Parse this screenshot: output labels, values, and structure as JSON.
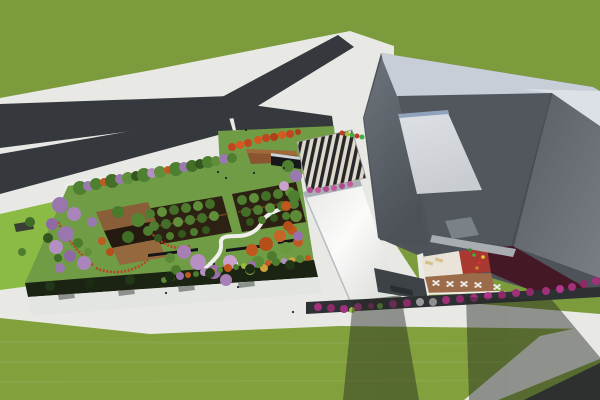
{
  "scene_type": "architectural-aerial-3d-render",
  "palette": {
    "grass_top": "#7c9b3c",
    "grass_bottom": "#82a03c",
    "pavement": "#e8e9e5",
    "asphalt": "#35383c",
    "lime_lawn": "#8cbb45",
    "garden_lawn": "#6f9c45",
    "walkway": "#ecedea",
    "hedge": "#1b2413",
    "facade": "#e3e5e2",
    "orchard_floor": "#2c2113",
    "stairs_dark": "#26262a",
    "stairs_light": "#ded9cb",
    "band_light": "#c8ced8",
    "band_lighter": "#dce1e7",
    "bldg_base": "#4d5358",
    "plane_mid": "#51575d",
    "skylight_edge": "#8fa3bd",
    "small_panel": "#7a8187",
    "fascia": "#a8adb2",
    "courtyard_cream": "#eae3d8",
    "courtyard_red": "#a83830",
    "courtyard_maroon": "#451826",
    "deck_brown": "#9c6b49",
    "deck_wedge": "#8a5530",
    "shelter_dark": "#17181a",
    "strip_dark": "#2e3134",
    "flatroof": "#3d4246",
    "shadow": "#23281f",
    "path_white": "#efefec",
    "red_flowers": "#c23b22",
    "table_white": "#f2f2f0",
    "lounger_beige": "#d9c08e",
    "person_dark": "#26262a"
  },
  "scene": {
    "trees": [
      [
        80,
        188,
        7,
        "#4f7f30"
      ],
      [
        88,
        186,
        5,
        "#9a78b0"
      ],
      [
        96,
        184,
        6,
        "#4f7f30"
      ],
      [
        104,
        182,
        4,
        "#c05a22"
      ],
      [
        112,
        181,
        7,
        "#446f28"
      ],
      [
        120,
        179,
        5,
        "#9a78b0"
      ],
      [
        128,
        178,
        6,
        "#5f8f38"
      ],
      [
        136,
        176,
        5,
        "#33571e"
      ],
      [
        144,
        175,
        7,
        "#4f7f30"
      ],
      [
        152,
        173,
        5,
        "#b48fc2"
      ],
      [
        160,
        172,
        6,
        "#5f8f38"
      ],
      [
        168,
        170,
        4,
        "#c05a22"
      ],
      [
        176,
        169,
        7,
        "#4f7f30"
      ],
      [
        184,
        167,
        5,
        "#9a78b0"
      ],
      [
        192,
        166,
        6,
        "#446f28"
      ],
      [
        200,
        164,
        5,
        "#33571e"
      ],
      [
        208,
        162,
        6,
        "#4f7f30"
      ],
      [
        216,
        161,
        5,
        "#5f8f38"
      ],
      [
        224,
        159,
        5,
        "#9a78b0"
      ],
      [
        232,
        158,
        5,
        "#4f7f30"
      ],
      [
        60,
        205,
        8,
        "#9a76ae"
      ],
      [
        74,
        214,
        7,
        "#aa85bc"
      ],
      [
        52,
        224,
        6,
        "#8f6ba6"
      ],
      [
        66,
        234,
        8,
        "#9a76ae"
      ],
      [
        56,
        247,
        7,
        "#b48fc2"
      ],
      [
        70,
        256,
        6,
        "#8f6ba6"
      ],
      [
        84,
        263,
        7,
        "#aa85bc"
      ],
      [
        60,
        268,
        5,
        "#9a76ae"
      ],
      [
        78,
        243,
        5,
        "#4c7b2e"
      ],
      [
        88,
        252,
        4,
        "#5f8f38"
      ],
      [
        92,
        222,
        5,
        "#9a78b0"
      ],
      [
        118,
        212,
        6,
        "#4a7a2c"
      ],
      [
        138,
        220,
        7,
        "#558433"
      ],
      [
        128,
        237,
        6,
        "#3f6d26"
      ],
      [
        148,
        231,
        5,
        "#4e7d2f"
      ],
      [
        102,
        241,
        4,
        "#c05a20"
      ],
      [
        110,
        252,
        4,
        "#b54f1a"
      ],
      [
        150,
        214,
        5,
        "#4e7d2f"
      ],
      [
        162,
        212,
        5,
        "#5f8f38"
      ],
      [
        174,
        210,
        5,
        "#446f28"
      ],
      [
        186,
        208,
        5,
        "#4e7d2f"
      ],
      [
        198,
        206,
        5,
        "#5f8f38"
      ],
      [
        210,
        204,
        5,
        "#446f28"
      ],
      [
        154,
        226,
        5,
        "#4e7d2f"
      ],
      [
        166,
        224,
        5,
        "#446f28"
      ],
      [
        178,
        222,
        5,
        "#5f8f38"
      ],
      [
        190,
        220,
        5,
        "#4e7d2f"
      ],
      [
        202,
        218,
        5,
        "#446f28"
      ],
      [
        214,
        216,
        5,
        "#5f8f38"
      ],
      [
        158,
        238,
        4,
        "#33571e"
      ],
      [
        170,
        236,
        4,
        "#4e7d2f"
      ],
      [
        182,
        234,
        4,
        "#33571e"
      ],
      [
        194,
        232,
        4,
        "#4e7d2f"
      ],
      [
        206,
        230,
        4,
        "#33571e"
      ],
      [
        242,
        200,
        5,
        "#4e7d2f"
      ],
      [
        254,
        198,
        5,
        "#5f8f38"
      ],
      [
        266,
        196,
        5,
        "#446f28"
      ],
      [
        278,
        194,
        5,
        "#4e7d2f"
      ],
      [
        290,
        192,
        5,
        "#5f8f38"
      ],
      [
        246,
        212,
        5,
        "#446f28"
      ],
      [
        258,
        210,
        5,
        "#4e7d2f"
      ],
      [
        270,
        208,
        5,
        "#5f8f38"
      ],
      [
        282,
        206,
        5,
        "#446f28"
      ],
      [
        294,
        204,
        5,
        "#4e7d2f"
      ],
      [
        250,
        222,
        4,
        "#33571e"
      ],
      [
        262,
        220,
        4,
        "#4e7d2f"
      ],
      [
        274,
        218,
        4,
        "#33571e"
      ],
      [
        286,
        216,
        4,
        "#4e7d2f"
      ],
      [
        184,
        252,
        7,
        "#a87fb5"
      ],
      [
        198,
        262,
        8,
        "#b88fc5"
      ],
      [
        214,
        272,
        7,
        "#9a6fae"
      ],
      [
        226,
        280,
        6,
        "#a87fb5"
      ],
      [
        170,
        258,
        5,
        "#5c8a36"
      ],
      [
        176,
        270,
        5,
        "#4e7c2d"
      ],
      [
        230,
        262,
        7,
        "#c9a0ce"
      ],
      [
        252,
        250,
        6,
        "#c2571d"
      ],
      [
        266,
        244,
        7,
        "#b54f1a"
      ],
      [
        280,
        236,
        6,
        "#c86426"
      ],
      [
        292,
        230,
        5,
        "#c2571d"
      ],
      [
        258,
        262,
        6,
        "#5d8c38"
      ],
      [
        272,
        256,
        5,
        "#4e7c2d"
      ],
      [
        286,
        248,
        6,
        "#6a9a40"
      ],
      [
        298,
        242,
        5,
        "#c05a22"
      ],
      [
        250,
        270,
        5,
        "#8fae4a"
      ],
      [
        264,
        268,
        4,
        "#d0a23a"
      ],
      [
        164,
        280,
        3,
        "#5c8a36"
      ],
      [
        172,
        278,
        3,
        "#a0b83c"
      ],
      [
        180,
        276,
        4,
        "#9a6fae"
      ],
      [
        188,
        275,
        3,
        "#c05a22"
      ],
      [
        196,
        274,
        3,
        "#4e7c2d"
      ],
      [
        204,
        272,
        4,
        "#b48fc2"
      ],
      [
        212,
        271,
        3,
        "#d0a23a"
      ],
      [
        220,
        270,
        3,
        "#5c8a36"
      ],
      [
        228,
        268,
        4,
        "#c2571d"
      ],
      [
        236,
        267,
        3,
        "#4e7c2d"
      ],
      [
        244,
        266,
        3,
        "#a0b83c"
      ],
      [
        252,
        265,
        4,
        "#9a6fae"
      ],
      [
        260,
        264,
        3,
        "#5c8a36"
      ],
      [
        268,
        263,
        3,
        "#c05a22"
      ],
      [
        276,
        262,
        4,
        "#4e7c2d"
      ],
      [
        284,
        261,
        3,
        "#b48fc2"
      ],
      [
        292,
        260,
        3,
        "#d0a23a"
      ],
      [
        300,
        259,
        4,
        "#5c8a36"
      ],
      [
        308,
        258,
        3,
        "#c2571d"
      ],
      [
        288,
        166,
        6,
        "#4f7f30"
      ],
      [
        296,
        176,
        6,
        "#9a78b0"
      ],
      [
        284,
        186,
        5,
        "#c9a0ce"
      ],
      [
        294,
        196,
        6,
        "#4f7f30"
      ],
      [
        286,
        206,
        5,
        "#c2571d"
      ],
      [
        296,
        216,
        6,
        "#5c8a36"
      ],
      [
        288,
        226,
        5,
        "#b54f1a"
      ],
      [
        298,
        236,
        5,
        "#9a6fae"
      ],
      [
        232,
        147,
        4,
        "#c2451f"
      ],
      [
        240,
        145,
        4,
        "#d4581f"
      ],
      [
        248,
        143,
        4,
        "#c2451f"
      ],
      [
        258,
        140,
        4,
        "#d4581f"
      ],
      [
        266,
        138,
        4,
        "#c2451f"
      ],
      [
        274,
        137,
        4,
        "#b03f1a"
      ],
      [
        282,
        135,
        4,
        "#d4581f"
      ],
      [
        290,
        134,
        4,
        "#c2451f"
      ],
      [
        298,
        132,
        3,
        "#b03f1a"
      ],
      [
        30,
        222,
        5,
        "#3f6d26"
      ],
      [
        48,
        238,
        5,
        "#33571e"
      ],
      [
        22,
        252,
        4,
        "#4e7d2f"
      ],
      [
        58,
        258,
        4,
        "#3f6d26"
      ],
      [
        50,
        286,
        5,
        "#223618"
      ],
      [
        90,
        283,
        5,
        "#1c2c12"
      ],
      [
        130,
        280,
        5,
        "#223618"
      ],
      [
        170,
        277,
        5,
        "#1c2c12"
      ],
      [
        210,
        273,
        5,
        "#223618"
      ],
      [
        250,
        269,
        5,
        "#1c2c12"
      ],
      [
        290,
        265,
        5,
        "#223618"
      ]
    ],
    "shrubs": [
      [
        318,
        307,
        4,
        "#a2307a"
      ],
      [
        331,
        308,
        4,
        "#8d2a68"
      ],
      [
        344,
        309,
        4,
        "#a2307a"
      ],
      [
        358,
        307,
        4,
        "#b0368a"
      ],
      [
        371,
        306,
        3,
        "#8d2a68"
      ],
      [
        393,
        304,
        4,
        "#a2307a"
      ],
      [
        407,
        303,
        4,
        "#8d2a68"
      ],
      [
        420,
        302,
        4,
        "#9a9a9a"
      ],
      [
        433,
        302,
        4,
        "#8f8f8f"
      ],
      [
        446,
        300,
        4,
        "#a2307a"
      ],
      [
        460,
        299,
        4,
        "#8d2a68"
      ],
      [
        474,
        298,
        4,
        "#a2307a"
      ],
      [
        488,
        296,
        4,
        "#b0368a"
      ],
      [
        502,
        295,
        4,
        "#8d2a68"
      ],
      [
        516,
        293,
        4,
        "#a2307a"
      ],
      [
        530,
        292,
        4,
        "#8d2a68"
      ],
      [
        546,
        291,
        4,
        "#a2307a"
      ],
      [
        560,
        289,
        4,
        "#b0368a"
      ],
      [
        572,
        287,
        4,
        "#a2307a"
      ],
      [
        584,
        284,
        4,
        "#8d2a68"
      ],
      [
        596,
        281,
        4,
        "#a2307a"
      ],
      [
        352,
        310,
        3,
        "#a0b83c"
      ],
      [
        380,
        306,
        3,
        "#6a9a40"
      ],
      [
        310,
        190,
        3,
        "#b04a8c"
      ],
      [
        318,
        190,
        3,
        "#c45a9a"
      ],
      [
        326,
        189,
        3,
        "#b04a8c"
      ],
      [
        334,
        188,
        3,
        "#c45a9a"
      ],
      [
        342,
        186,
        3,
        "#b04a8c"
      ],
      [
        350,
        184,
        3,
        "#c45a9a"
      ],
      [
        342,
        133,
        2.5,
        "#c03a2a"
      ],
      [
        347,
        134,
        2.5,
        "#a0b83c"
      ],
      [
        352,
        135,
        2.5,
        "#3fae3f"
      ],
      [
        357,
        136,
        2.5,
        "#c03a2a"
      ],
      [
        362,
        137,
        2.5,
        "#3fae3f"
      ]
    ],
    "tables": [
      [
        436,
        283
      ],
      [
        450,
        284
      ],
      [
        464,
        284
      ],
      [
        478,
        285
      ],
      [
        497,
        287
      ]
    ],
    "loungers": [
      [
        429,
        263
      ],
      [
        439,
        260
      ]
    ],
    "play_items": [
      [
        474,
        255,
        "#3fae3f"
      ],
      [
        479,
        263,
        "#cc3430"
      ],
      [
        483,
        257,
        "#e5c832"
      ],
      [
        470,
        250,
        "#2e8f2e"
      ],
      [
        477,
        268,
        "#cc8430"
      ]
    ],
    "people": [
      [
        226,
        178
      ],
      [
        254,
        173
      ],
      [
        284,
        168
      ],
      [
        312,
        161
      ],
      [
        218,
        172
      ],
      [
        238,
        287
      ],
      [
        214,
        264
      ],
      [
        293,
        312
      ],
      [
        166,
        293
      ],
      [
        246,
        130
      ]
    ]
  }
}
